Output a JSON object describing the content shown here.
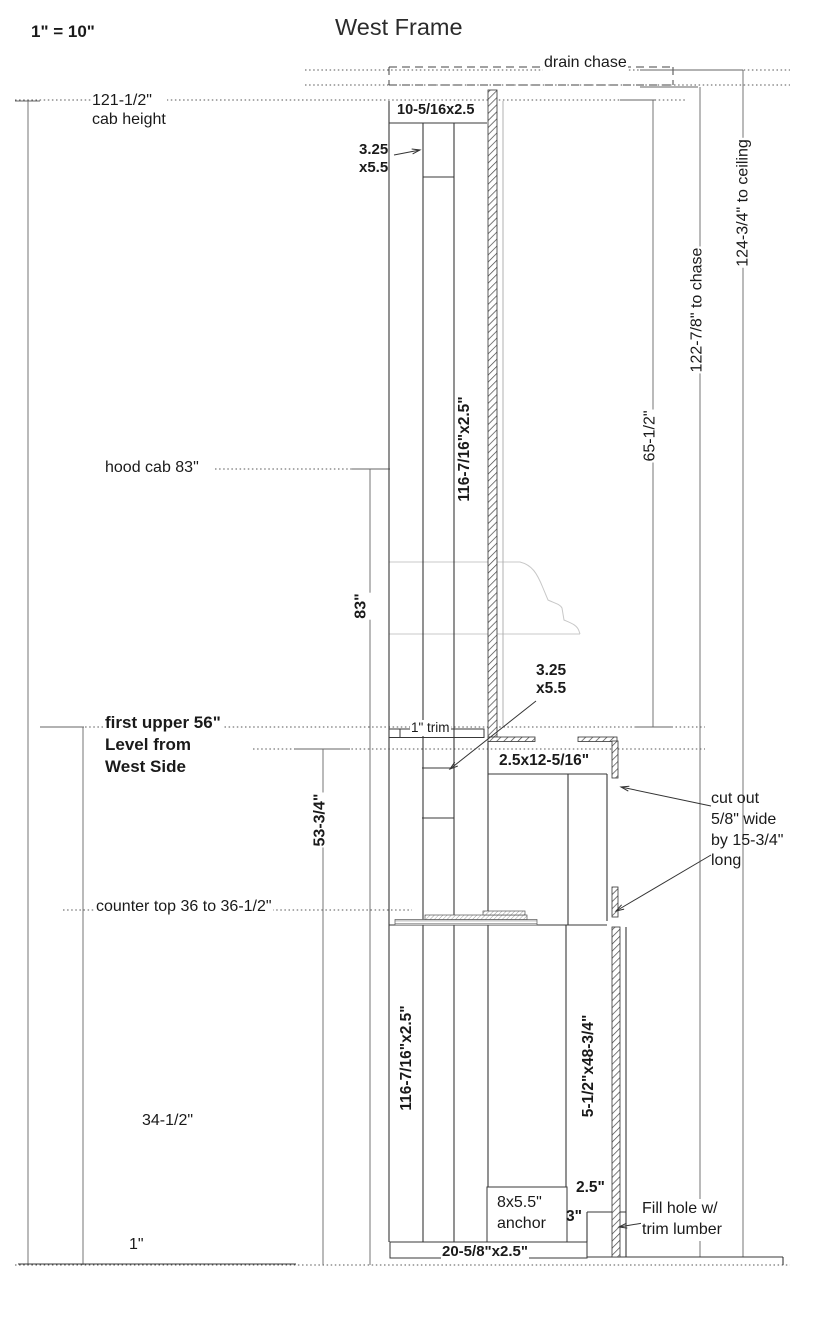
{
  "header": {
    "scale_note": "1\" = 10\"",
    "title": "West Frame"
  },
  "labels": {
    "drain_chase": "drain chase",
    "cab_height": "121-1/2\"\ncab height",
    "to_ceiling": "124-3/4\" to ceiling",
    "to_chase": "122-7/8\" to chase",
    "dim_65_5": "65-1/2\"",
    "top_plate": "10-5/16x2.5",
    "block_upper": "3.25\nx5.5",
    "board_upper": "116-7/16\"x2.5\"",
    "hood_cab": "hood cab 83\"",
    "dim_83": "83\"",
    "block_mid": "3.25\nx5.5",
    "trim_1in": "1\" trim",
    "first_upper": "first upper 56\"\nLevel from\nWest Side",
    "dim_53_75": "53-3/4\"",
    "header_board": "2.5x12-5/16\"",
    "cut_out": "cut out\n5/8\" wide\nby 15-3/4\"\nlong",
    "counter_top": "counter top 36 to 36-1/2\"",
    "board_lower": "116-7/16\"x2.5\"",
    "side_board": "5-1/2\"x48-3/4\"",
    "dim_34_5": "34-1/2\"",
    "anchor": "8x5.5\"\nanchor",
    "dim_2_5": "2.5\"",
    "dim_3": "3\"",
    "fill_hole": "Fill hole w/\ntrim lumber",
    "dim_1": "1\"",
    "sill": "20-5/8\"x2.5\""
  },
  "colors": {
    "frame_line": "#383838",
    "dimension_line": "#666666",
    "hood_outline": "#c8c8c8",
    "text": "#1a1a1a"
  }
}
